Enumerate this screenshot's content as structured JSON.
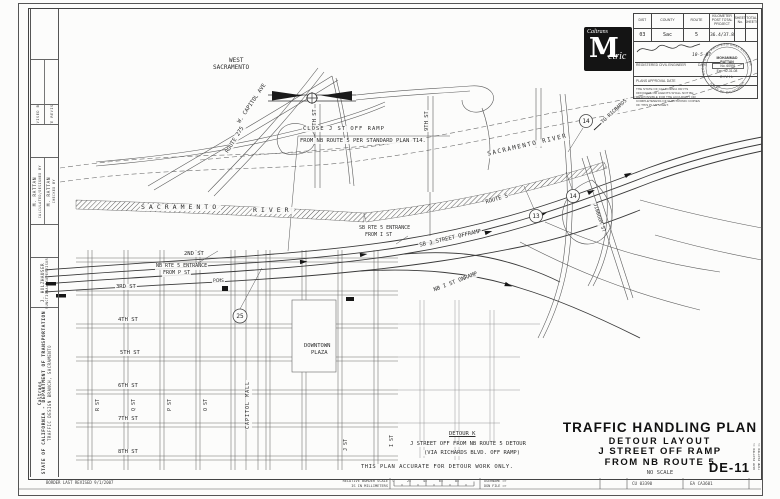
{
  "titleblock": {
    "logo_brand": "Caltrans",
    "logo_m": "M",
    "logo_rest": "etric",
    "cols": [
      {
        "h": "DIST",
        "v": "03"
      },
      {
        "h": "COUNTY",
        "v": "Sac"
      },
      {
        "h": "ROUTE",
        "v": "5"
      },
      {
        "h": "KILOMETER POST TOTAL PROJECT",
        "v": "36.4/37.8"
      },
      {
        "h": "SHEET No.",
        "v": ""
      },
      {
        "h": "TOTAL SHEETS",
        "v": ""
      }
    ],
    "registered": "REGISTERED CIVIL ENGINEER",
    "date_label": "DATE",
    "date_value": "10-5-07",
    "approval": "PLANS APPROVAL DATE",
    "disclaimer": "THE STATE OF CALIFORNIA OR ITS OFFICERS OR AGENTS SHALL NOT BE RESPONSIBLE FOR THE ACCURACY OR COMPLETENESS OF ELECTRONIC COPIES OF THIS PLAN SHEET.",
    "stamp": {
      "arc_top": "REGISTERED PROFESSIONAL ENGINEER",
      "arc_bottom": "STATE OF CALIFORNIA",
      "name": "MOHAMMAD RATTAN",
      "no": "No. 60991",
      "exp": "Exp. 12-31-08",
      "discipline": "CIVIL"
    }
  },
  "sidebar": {
    "revised_by": "REVISED BY",
    "date_revised": "DATE REVISED",
    "designed_name": "M. RATTAN",
    "designed_label": "CALCULATED/DESIGNED BY",
    "checked_name": "M. RATTAN",
    "checked_label": "CHECKED BY",
    "supervisor_name": "J. HOLZHAUSER",
    "supervisor_label": "FUNCTIONAL SUPERVISOR",
    "logo_text": "Caltrans",
    "agency": "STATE OF CALIFORNIA - DEPARTMENT OF TRANSPORTATION",
    "branch": "TRAFFIC DESIGN BRANCH, SACRAMENTO"
  },
  "maintitle": {
    "l1": "TRAFFIC HANDLING PLAN",
    "l2": "DETOUR LAYOUT",
    "l3": "J STREET OFF RAMP",
    "l4": "FROM NB ROUTE 5",
    "scale": "NO SCALE",
    "sheet_code": "DE-11"
  },
  "notes": {
    "close1": "CLOSE J ST OFF RAMP",
    "close2": "FROM NB ROUTE 5 PER STANDARD PLAN T14.",
    "detour_title": "DETOUR K",
    "detour1": "J STREET OFF FROM NB ROUTE 5 DETOUR",
    "detour2": "(VIA RICHARDS BLVD. OFF RAMP)",
    "accuracy": "THIS PLAN ACCURATE FOR DETOUR WORK ONLY."
  },
  "map": {
    "labels": {
      "west1": "WEST",
      "west2": "SACRAMENTO",
      "w_capitol": "W. CAPITOL AVE",
      "route275": "ROUTE 275",
      "st5_top": "5TH ST",
      "st9_top": "9TH ST",
      "river_a1": "SACRAMENTO",
      "river_a2": "RIVER",
      "river_b": "SACRAMENTO RIVER",
      "r2": "2ND ST",
      "r3": "3RD ST",
      "r4": "4TH ST",
      "r5": "5TH ST",
      "r6": "6TH ST",
      "r7": "7TH ST",
      "r8": "8TH ST",
      "cR": "R ST",
      "cQ": "Q ST",
      "cP": "P ST",
      "cO": "O ST",
      "mall": "CAPITOL MALL",
      "cJ": "J ST",
      "cI": "I ST",
      "downtown1": "DOWNTOWN",
      "downtown2": "PLAZA",
      "nb_ent1": "NB RTE 5 ENTRANCE",
      "nb_ent2": "FROM P ST",
      "sb_ent1": "SB RTE 5 ENTRANCE",
      "sb_ent2": "FROM I ST",
      "sb_off": "SB J STREET OFFRAMP",
      "nb_on": "NB I ST ONRAMP",
      "route5": "ROUTE 5",
      "jibboom": "JIBBOOM ST",
      "to_richards": "TO RICHARDS",
      "pcms": "PCMS"
    },
    "markers": {
      "m1": "25",
      "m2": "13",
      "m3": "14",
      "m4": "14"
    }
  },
  "footer": {
    "revised": "BORDER LAST REVISED 9/1/2007",
    "rel1": "RELATIVE BORDER SCALE",
    "rel2": "IS IN MILLIMETERS",
    "ticks": [
      "0",
      "20",
      "40",
      "60",
      "80"
    ],
    "username": "USERNAME =>",
    "dgn": "DGN FILE =>",
    "cu": "CU 03390",
    "ea": "EA CA3601",
    "plot1": "DATE PLOTTED =>",
    "plot2": "TIME PLOTTED =>"
  }
}
